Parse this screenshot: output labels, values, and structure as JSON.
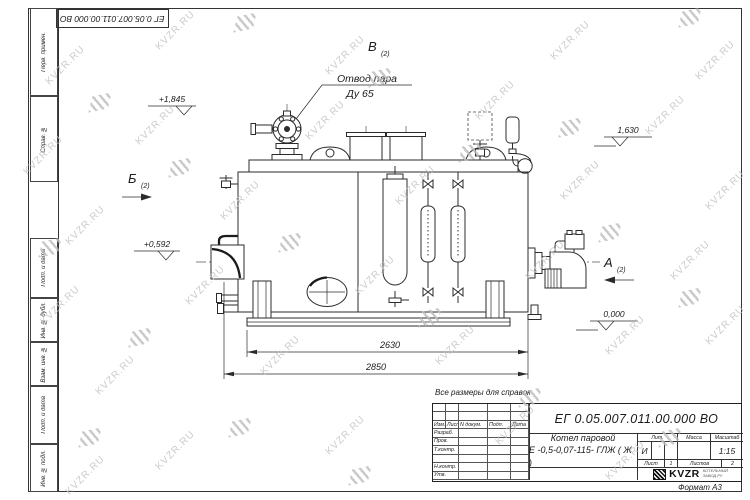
{
  "watermark": {
    "text": "KVZR.RU"
  },
  "sheet": {
    "top_designation": "ЕГ 0.05.007.011.00.000  ВО",
    "format_note": "Формат А3",
    "reference_note": "Все размеры для справок",
    "margin_labels": [
      "Перв. примен.",
      "Справ. №",
      "Подп. и дата",
      "Инв. № дубл.",
      "Взам. инв. №",
      "Подп. и дата",
      "Инв. № подл."
    ]
  },
  "drawing": {
    "callout": {
      "line1": "Отвод пара",
      "line2": "Ду 65"
    },
    "views": {
      "v": "В",
      "b": "Б",
      "a": "А",
      "sheet_ref": "(2)"
    },
    "elevations": {
      "top_left": "+1,845",
      "top_right": "1,630",
      "mid_left": "+0,592",
      "base": "0,000"
    },
    "dimensions": {
      "inner": "2630",
      "overall": "2850"
    }
  },
  "title_block": {
    "designation": "ЕГ 0.05.007.011.00.000  ВО",
    "name_line1": "Котел паровой",
    "name_line2": "Е -0,5-0,07-115- ГЛЖ ( Ж )",
    "header_cols": [
      "Изм.",
      "Лист",
      "N докум.",
      "Подп.",
      "Дата"
    ],
    "sign_rows": [
      "Разраб.",
      "Пров.",
      "Т.контр.",
      "",
      "Н.контр.",
      "Утв."
    ],
    "lit_label": "Лит.",
    "lit_value": "И",
    "mass_label": "Масса",
    "scale_label": "Масштаб",
    "scale_value": "1:15",
    "sheet_label": "Лист",
    "sheet_value": "1",
    "sheets_label": "Листов",
    "sheets_value": "2",
    "logo_text": "KVZR",
    "logo_sub1": "КОТЕЛЬНЫЙ",
    "logo_sub2": "ЗАВОД.РУ"
  }
}
